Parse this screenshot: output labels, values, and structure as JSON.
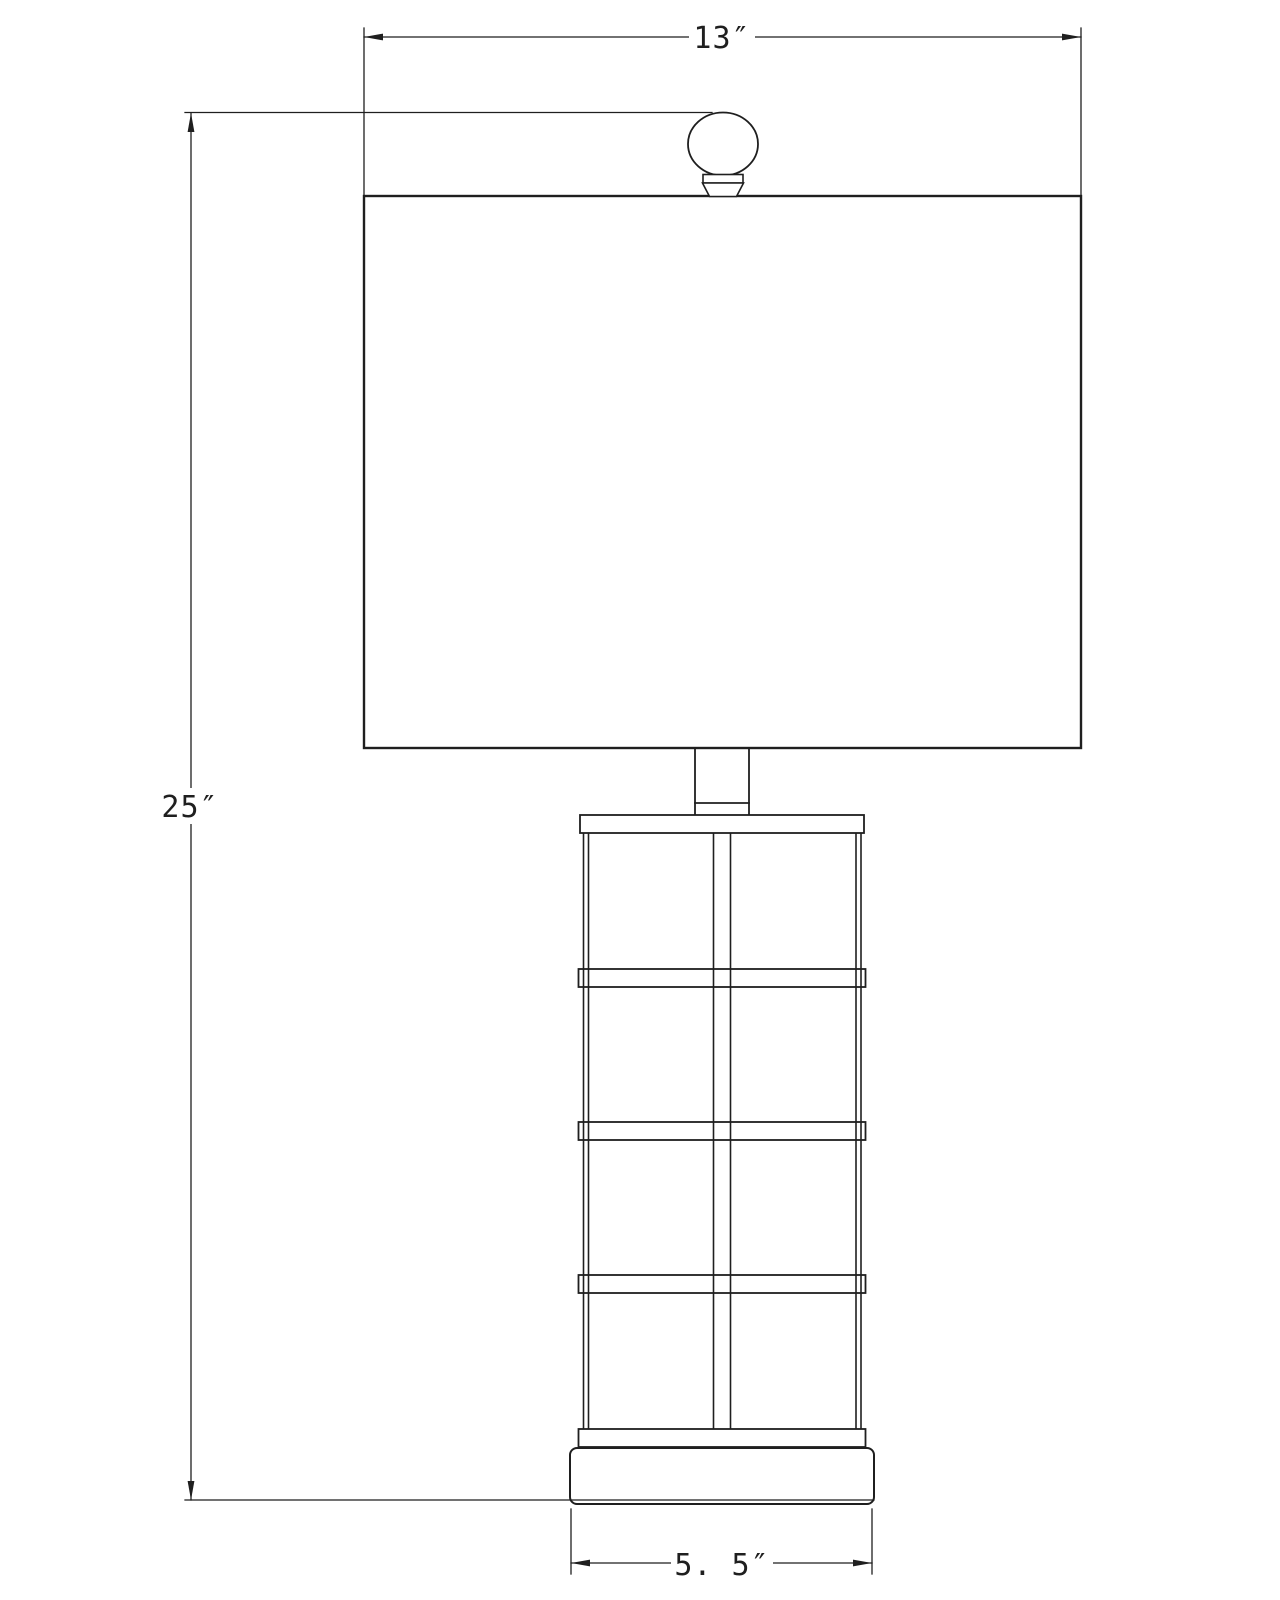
{
  "drawing": {
    "type": "technical-dimension-drawing",
    "subject": "table-lamp-front-elevation",
    "background_color": "#ffffff",
    "line_color": "#1f1f1f",
    "dimensions": {
      "width": {
        "label": "13″",
        "applies_to": "shade-width"
      },
      "height": {
        "label": "25″",
        "applies_to": "overall-height"
      },
      "base_width": {
        "label": "5. 5″",
        "applies_to": "base-width"
      }
    },
    "parts": {
      "finial": "ball-finial",
      "shade": "rectangular-drum-shade",
      "neck": "neck",
      "body": "caged-grid-column",
      "base": "plinth-base"
    }
  }
}
